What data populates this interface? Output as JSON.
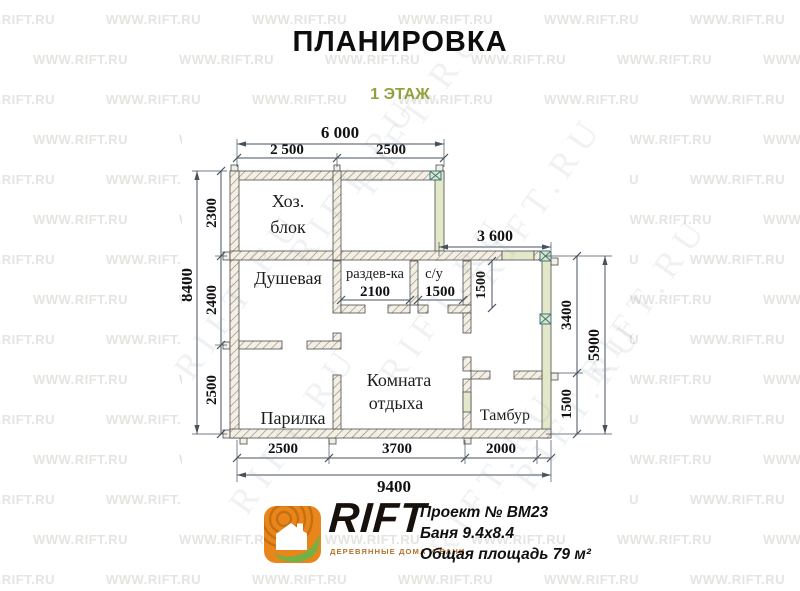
{
  "header": {
    "title": "ПЛАНИРОВКА",
    "subtitle": "1 ЭТАЖ"
  },
  "plan": {
    "rooms": {
      "hoz": {
        "line1": "Хоз.",
        "line2": "блок"
      },
      "dushevaya": "Душевая",
      "razdevka": "раздев-ка",
      "su": "с/у",
      "komnata": {
        "line1": "Комната",
        "line2": "отдыха"
      },
      "parilka": "Парилка",
      "tambur": "Тамбур"
    },
    "dims": {
      "top_total": "6 000",
      "top_a": "2 500",
      "top_b": "2500",
      "left_total": "8400",
      "left_a": "2300",
      "left_b": "2400",
      "left_c": "2500",
      "wing_top": "3 600",
      "right_a": "3400",
      "right_b": "1500",
      "right_total": "5900",
      "bottom_a": "2500",
      "bottom_b": "3700",
      "bottom_c": "2000",
      "bottom_total": "9400",
      "razdevka_width": "2100",
      "su_width": "1500",
      "wing_inner": "1500"
    }
  },
  "footer": {
    "logo": {
      "wordmark": "RIFT",
      "tagline": "ДЕРЕВЯННЫЕ ДОМА И БАНИ",
      "icon_color": "#E8861B",
      "ring_color": "#c76f10",
      "leaf_color": "#76B043"
    },
    "project_lines": [
      "Проект № ВМ23",
      "Баня 9.4х8.4",
      "Общая площадь 79 м²"
    ]
  },
  "watermarks": {
    "diagonal_text": "RIFT.RU",
    "grid_text": "WWW.RIFT.RU",
    "diagonal_positions": [
      [
        215,
        295
      ],
      [
        330,
        180
      ],
      [
        270,
        430
      ],
      [
        420,
        300
      ],
      [
        515,
        200
      ],
      [
        555,
        405
      ],
      [
        395,
        110
      ],
      [
        470,
        475
      ],
      [
        620,
        300
      ]
    ]
  }
}
